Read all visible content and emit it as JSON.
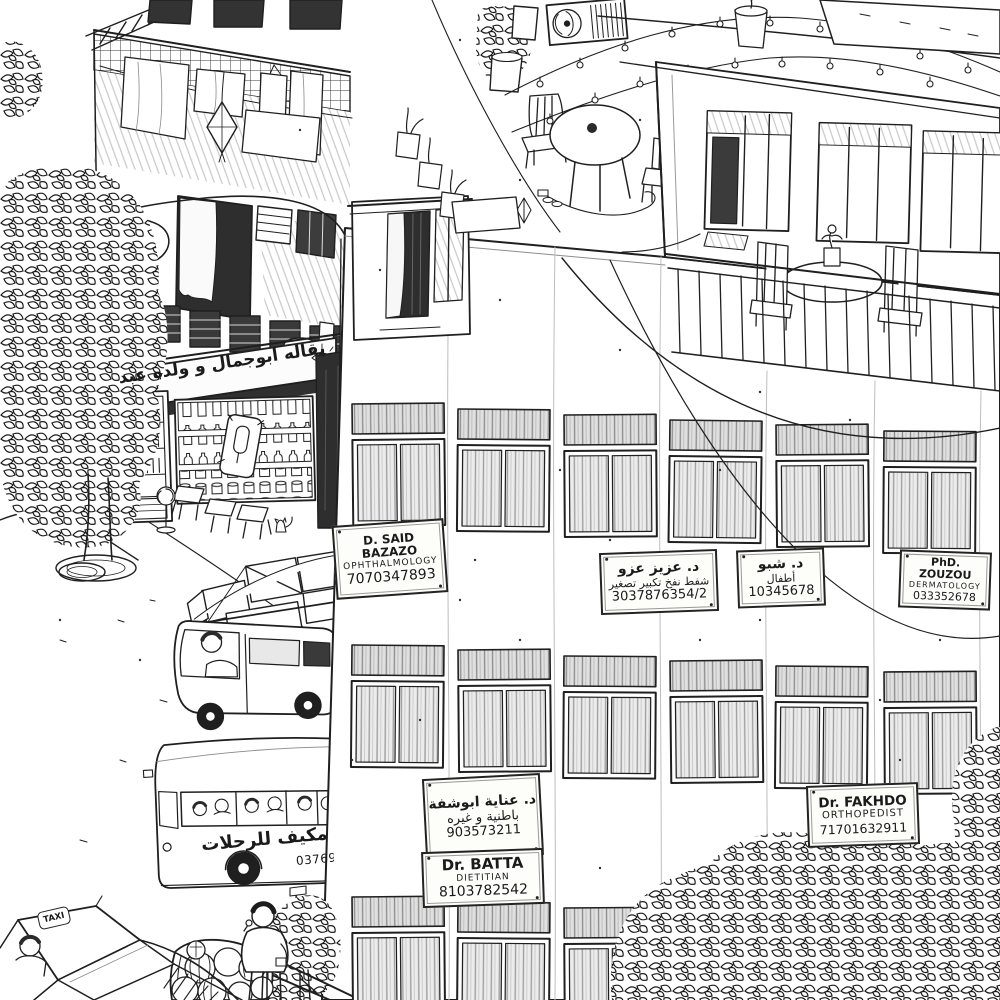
{
  "colors": {
    "ink": "#1f1f1f",
    "paper": "#ffffff",
    "window_shade": "#e9e9e9",
    "dark_opening": "#2e2e2e",
    "pencil_shade": "#c9c9c9"
  },
  "building_signs": [
    {
      "doctor": "D. SAID BAZAZO",
      "specialty": "OPHTHALMOLOGY",
      "phone": "7070347893"
    },
    {
      "doctor": "د. عزيز عزو",
      "specialty": "شفط نفخ تكبير تصغير",
      "phone": "3037876354/2"
    },
    {
      "doctor": "د. شبو",
      "specialty": "أطفال",
      "phone": "10345678"
    },
    {
      "doctor": "PhD. ZOUZOU",
      "specialty": "DERMATOLOGY",
      "phone": "033352678"
    },
    {
      "doctor": "د. عناية ابوشفة",
      "specialty": "باطنية و غيره",
      "phone": "903573211"
    },
    {
      "doctor": "Dr. BATTA",
      "specialty": "DIETITIAN",
      "phone": "8103782542"
    },
    {
      "doctor": "Dr. FAKHDO",
      "specialty": "ORTHOPEDIST",
      "phone": "71701632911"
    }
  ],
  "shop": {
    "awning_text": "بقاله ابوجمال و ولده عبد"
  },
  "bus": {
    "side_text": "مكيف للرحلات",
    "phone": "03769154"
  },
  "taxi": {
    "sign_text": "TAXI"
  }
}
